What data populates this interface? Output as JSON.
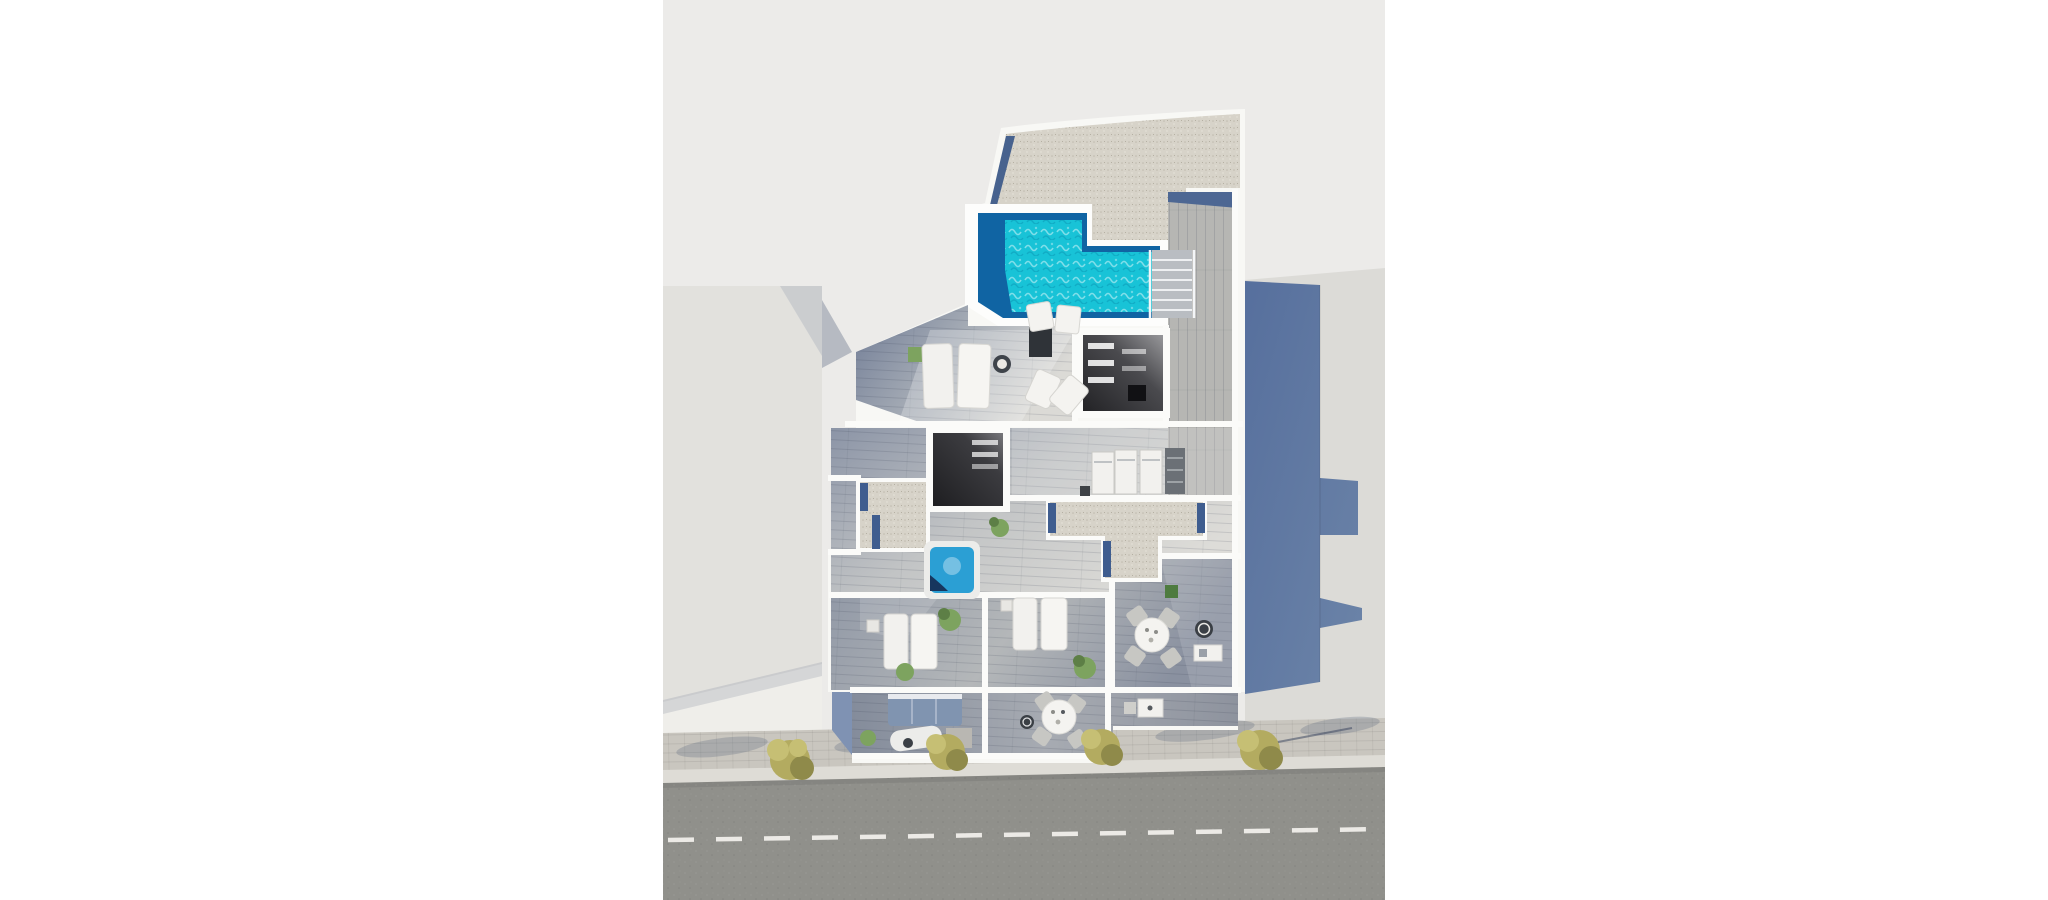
{
  "scene": {
    "kind": "aerial-3d-architectural-render",
    "subject": "rooftop floor plan with pool, terraces, balconies and street",
    "elements": [
      "rooftop-pool",
      "gravel-roof",
      "wood-deck",
      "stairs",
      "skylight-openings",
      "hot-tub",
      "sun-loungers",
      "dining-tables",
      "balconies",
      "sofa",
      "neighbor-buildings",
      "sidewalk-bushes",
      "road-with-dashed-line"
    ]
  },
  "colors": {
    "page": "#ffffff",
    "ground": "#ecebe9",
    "wall": "#f8f8f5",
    "wall_bright": "#fdfdfc",
    "gravel": "#d7d3c9",
    "pool_teal": "#18c3d7",
    "pool_deep": "#1064a3",
    "deck_plank": "#b6b6b3",
    "deck_shadow": "#4d6793",
    "floor_dark": "#76829b",
    "floor_mid": "#9aa1ad",
    "floor_light": "#d9d8d4",
    "skylight_dark": "#28282b",
    "skylight_mid": "#8c8c8f",
    "shadow_blue": "#5c76a2",
    "shadow_soft": "rgba(90,105,135,0.2)",
    "neighbor_left": "#e2e1dd",
    "neighbor_right": "#dcdbd7",
    "gap_shadow": "#b6bac2",
    "road": "#90908b",
    "road_line": "#eceae6",
    "paving": "#c9c6bf",
    "curb": "#dedcd6",
    "bush": "#b3ab60",
    "bush_light": "#c6bf74",
    "bush_dark": "#8f8a4a",
    "plant": "#7da35f",
    "plant_dark": "#5d7f46",
    "sofa": "#8094b0",
    "hot_tub_water": "#2b9fd4",
    "furniture_white": "#f2f1ee",
    "furniture_gray": "#c7c7c3",
    "table_dark": "#3a3f45",
    "appliance_dark": "#6b7076",
    "stair": "#b9bdc2",
    "railing": "#f4f6f8",
    "balcony_shade": "#7f92b3"
  }
}
